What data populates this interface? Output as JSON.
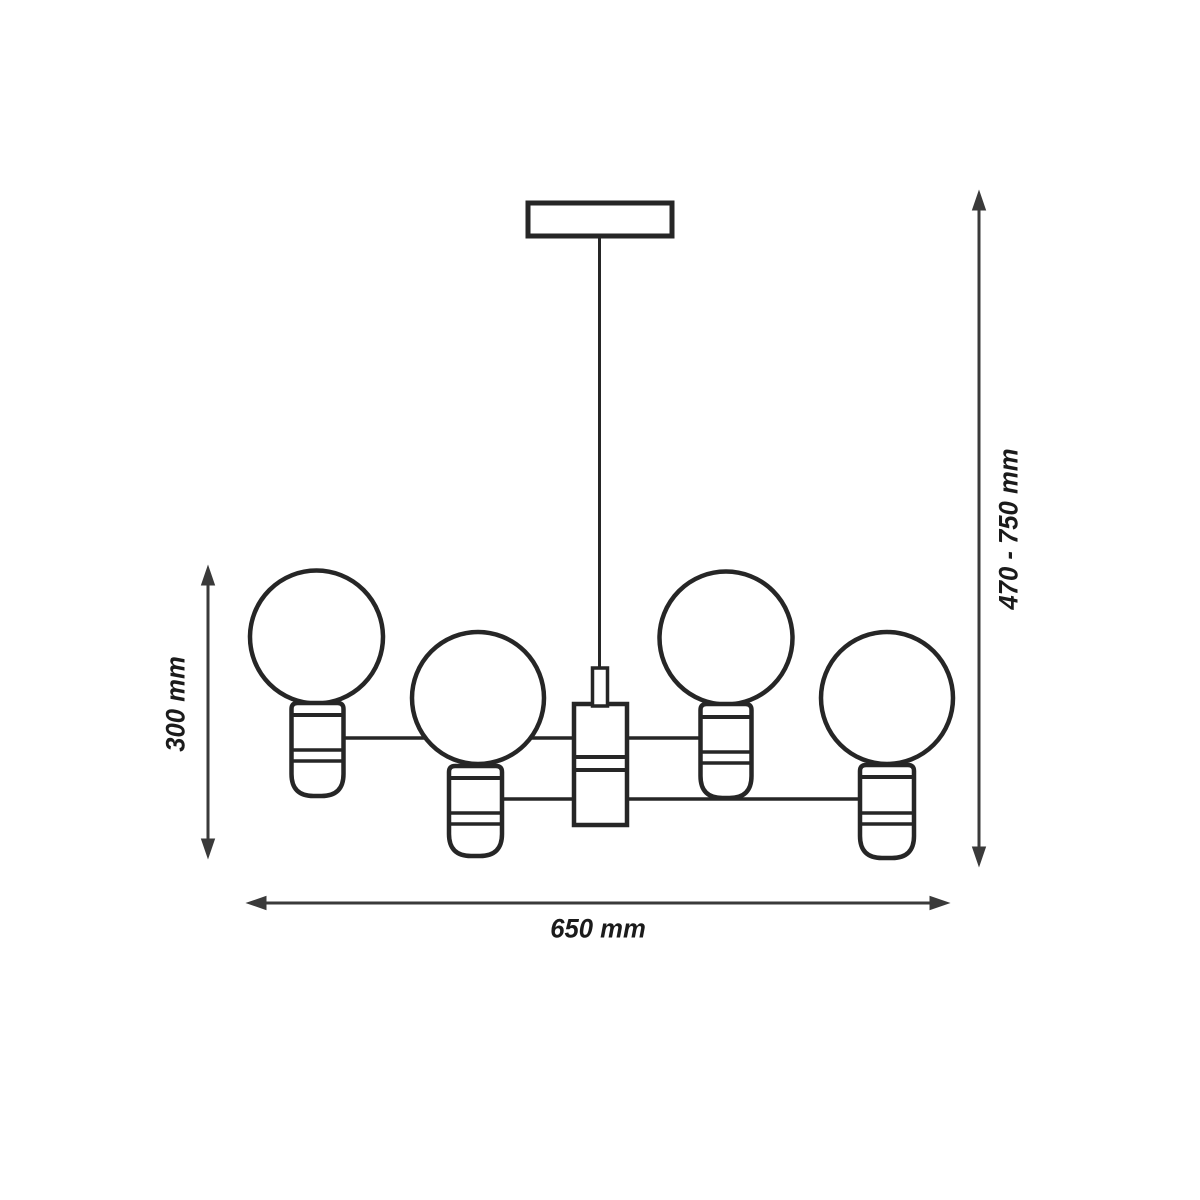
{
  "diagram": {
    "kind": "chandelier-dimension-drawing",
    "bulb_count": 4,
    "labels": {
      "fixture_height": "300 mm",
      "overall_height": "470 - 750 mm",
      "width": "650 mm"
    },
    "colors": {
      "line": "#262626",
      "dimension": "#3a3a3a",
      "text": "#1b1b1b",
      "background": "#ffffff"
    }
  }
}
